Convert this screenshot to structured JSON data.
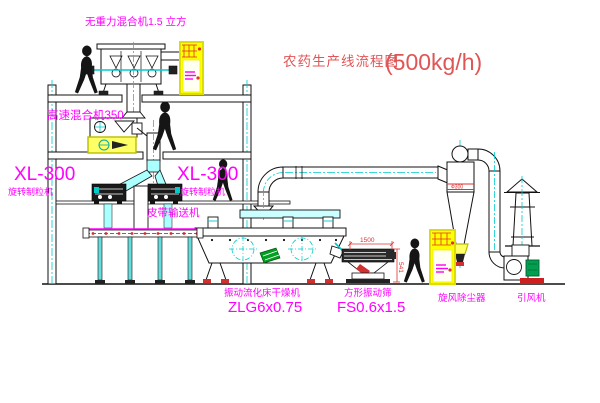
{
  "title": {
    "main": "农药生产线流程图",
    "capacity": "(500kg/h)"
  },
  "labels": {
    "zero_gravity_mixer": "无重力混合机1.5 立方",
    "high_speed_mixer": "高速混合机350",
    "granulator_model_left": "XL-300",
    "granulator_name_left": "旋转制粒机",
    "granulator_model_right": "XL-300",
    "granulator_name_right": "旋转制粒机",
    "belt_conveyor": "皮带输送机",
    "fluid_bed_dryer": "振动流化床干燥机",
    "fluid_bed_dryer_model": "ZLG6x0.75",
    "vibrating_screen": "方形振动筛",
    "vibrating_screen_model": "FS0.6x1.5",
    "cyclone": "旋风除尘器",
    "induced_draft_fan": "引风机"
  },
  "dimensions": {
    "screen_length": "1500",
    "screen_height": "541",
    "cyclone_band": "Ф300"
  },
  "colors": {
    "label_magenta": "#ff00ff",
    "title_red": "#e05555",
    "centerline_cyan": "#00cccc",
    "highlight_yellow": "#ffff00",
    "motor_green": "#00a050",
    "status_red": "#d03030"
  }
}
